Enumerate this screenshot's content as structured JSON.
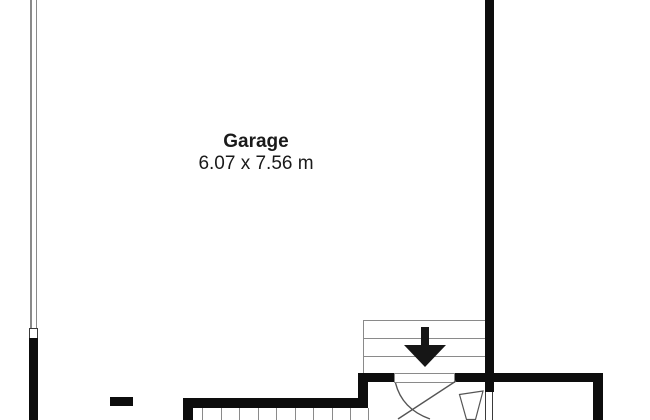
{
  "plan": {
    "room": {
      "name": "Garage",
      "dimensions": "6.07 x 7.56 m"
    },
    "stairs": {
      "upper": {
        "direction_icon": "arrow-down",
        "visible_treads": 3
      },
      "lower": {
        "visible_treads": 10
      }
    },
    "colors": {
      "bg": "#ffffff",
      "wall": "#0d0d0d",
      "line": "#8a8a8a",
      "door": "#555555",
      "frame": "#3a3a3a",
      "text": "#1a1a1a",
      "arrow": "#161616"
    }
  }
}
